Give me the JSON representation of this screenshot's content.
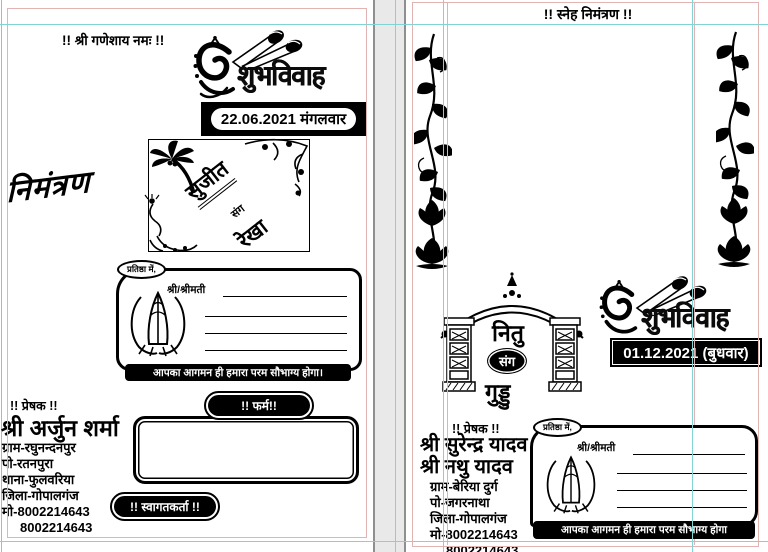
{
  "colors": {
    "guide_cyan": "#82d4d4",
    "margin_pink": "#e2b3b3",
    "ink": "#000000",
    "paper": "#ffffff"
  },
  "logo_text": "शुभविवाह",
  "left_page": {
    "ganesh_header": "!! श्री गणेशाय नमः !!",
    "date": "22.06.2021 मंगलवार",
    "nimantran": "निमंत्रण",
    "couple": {
      "groom": "सुजीत",
      "conjunction": "संग",
      "bride": "रेखा"
    },
    "guest_box": {
      "tab": "प्रतिष्ठा में,",
      "salutation": "श्री/श्रीमती",
      "blessing": "आपका आगमन ही हमारा परम सौभाग्य होगा।"
    },
    "sender": {
      "heading": "!! प्रेषक !!",
      "name": "श्री अर्जुन शर्मा",
      "lines": [
        "ग्राम-रघुनन्दनपुर",
        "पो-रतनपुरा",
        "थाना-फुलवरिया",
        "जिला-गोपालगंज",
        "मो-8002214643",
        "8002214643"
      ]
    },
    "firm_pill": "!! फर्म!!",
    "welcome_pill": "!! स्वागतकर्ता !!"
  },
  "right_page": {
    "header": "!! स्नेह निमंत्रण !!",
    "couple": {
      "groom": "नितु",
      "conjunction": "संग",
      "bride": "गुड्डु"
    },
    "date": "01.12.2021 (बुधवार)",
    "sender": {
      "heading": "!! प्रेषक !!",
      "names": [
        "श्री सुरेन्द्र यादव",
        "श्री नथु यादव"
      ],
      "lines": [
        "ग्राम-बेरिया दुर्ग",
        "पो-जगरनाथा",
        "जिला-गोपालगंज",
        "मो-8002214643",
        "8002214643"
      ]
    },
    "guest_box": {
      "tab": "प्रतिष्ठा में,",
      "salutation": "श्री/श्रीमती",
      "blessing": "आपका आगमन ही हमारा परम सौभाग्य होगा"
    }
  }
}
